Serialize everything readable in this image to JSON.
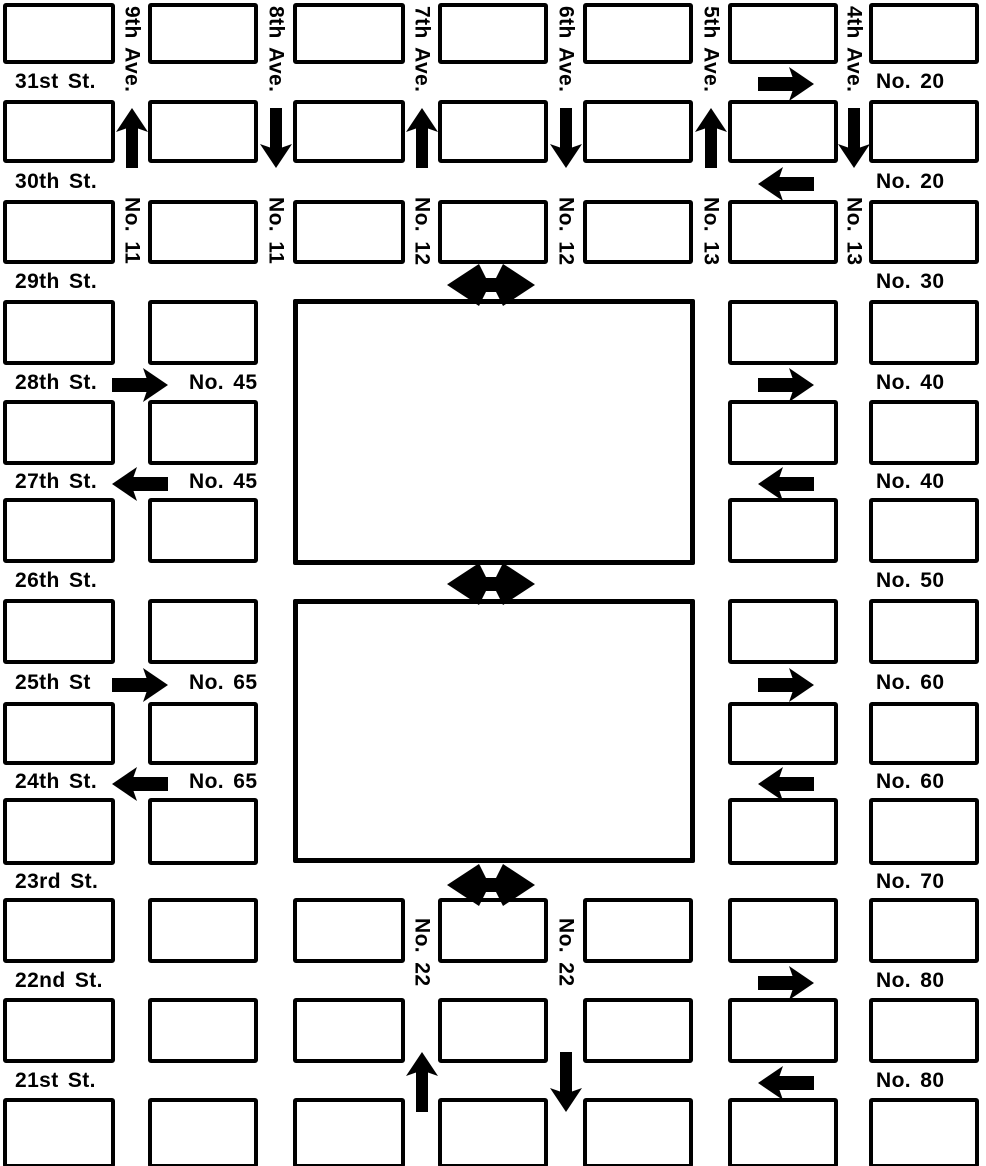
{
  "map": {
    "colors": {
      "ink": "#000000",
      "paper": "#ffffff"
    },
    "street_labels": [
      {
        "label": "31st St.",
        "row": 0
      },
      {
        "label": "30th St.",
        "row": 1
      },
      {
        "label": "29th St.",
        "row": 2
      },
      {
        "label": "28th St.",
        "row": 3
      },
      {
        "label": "27th St.",
        "row": 4
      },
      {
        "label": "26th St.",
        "row": 5
      },
      {
        "label": "25th St",
        "row": 6
      },
      {
        "label": "24th St.",
        "row": 7
      },
      {
        "label": "23rd St.",
        "row": 8
      },
      {
        "label": "22nd St.",
        "row": 9
      },
      {
        "label": "21st St.",
        "row": 10
      }
    ],
    "avenue_labels": [
      {
        "label": "9th Ave.",
        "avenue": 0
      },
      {
        "label": "8th Ave.",
        "avenue": 1
      },
      {
        "label": "7th Ave.",
        "avenue": 2
      },
      {
        "label": "6th Ave.",
        "avenue": 3
      },
      {
        "label": "5th Ave.",
        "avenue": 4
      },
      {
        "label": "4th Ave.",
        "avenue": 5
      }
    ],
    "route_labels_right": [
      {
        "label": "No. 20",
        "street_band": 0
      },
      {
        "label": "No. 20",
        "street_band": 1
      },
      {
        "label": "No. 30",
        "street_band": 2
      },
      {
        "label": "No. 40",
        "street_band": 3
      },
      {
        "label": "No. 40",
        "street_band": 4
      },
      {
        "label": "No. 50",
        "street_band": 5
      },
      {
        "label": "No. 60",
        "street_band": 6
      },
      {
        "label": "No. 60",
        "street_band": 7
      },
      {
        "label": "No. 70",
        "street_band": 8
      },
      {
        "label": "No. 80",
        "street_band": 9
      },
      {
        "label": "No. 80",
        "street_band": 10
      }
    ],
    "route_labels_mid": [
      {
        "label": "No. 45",
        "street_band": 3
      },
      {
        "label": "No. 45",
        "street_band": 4
      },
      {
        "label": "No. 65",
        "street_band": 6
      },
      {
        "label": "No. 65",
        "street_band": 7
      }
    ],
    "route_labels_vertical": [
      {
        "label": "No. 11",
        "avenue": 0,
        "row": 2
      },
      {
        "label": "No. 11",
        "avenue": 1,
        "row": 2
      },
      {
        "label": "No. 12",
        "avenue": 2,
        "row": 2
      },
      {
        "label": "No. 12",
        "avenue": 3,
        "row": 2
      },
      {
        "label": "No. 13",
        "avenue": 4,
        "row": 2
      },
      {
        "label": "No. 13",
        "avenue": 5,
        "row": 2
      },
      {
        "label": "No. 22",
        "avenue": 2,
        "row": 9
      },
      {
        "label": "No. 22",
        "avenue": 3,
        "row": 9
      }
    ],
    "arrows": [
      {
        "dir": "up",
        "avenue": 0,
        "row": 1
      },
      {
        "dir": "down",
        "avenue": 1,
        "row": 1
      },
      {
        "dir": "up",
        "avenue": 2,
        "row": 1
      },
      {
        "dir": "down",
        "avenue": 3,
        "row": 1
      },
      {
        "dir": "up",
        "avenue": 4,
        "row": 1
      },
      {
        "dir": "down",
        "avenue": 5,
        "row": 1
      },
      {
        "dir": "up",
        "avenue": 2,
        "row": 10
      },
      {
        "dir": "down",
        "avenue": 3,
        "row": 10
      },
      {
        "dir": "right",
        "street_band": 0,
        "side": "right"
      },
      {
        "dir": "left",
        "street_band": 1,
        "side": "right"
      },
      {
        "dir": "right",
        "street_band": 3,
        "side": "left"
      },
      {
        "dir": "right",
        "street_band": 3,
        "side": "right"
      },
      {
        "dir": "left",
        "street_band": 4,
        "side": "left"
      },
      {
        "dir": "left",
        "street_band": 4,
        "side": "right"
      },
      {
        "dir": "right",
        "street_band": 6,
        "side": "left"
      },
      {
        "dir": "right",
        "street_band": 6,
        "side": "right"
      },
      {
        "dir": "left",
        "street_band": 7,
        "side": "left"
      },
      {
        "dir": "left",
        "street_band": 7,
        "side": "right"
      },
      {
        "dir": "right",
        "street_band": 9,
        "side": "right"
      },
      {
        "dir": "left",
        "street_band": 10,
        "side": "right"
      },
      {
        "dir": "double",
        "street_band": 2
      },
      {
        "dir": "double",
        "street_band": 5
      },
      {
        "dir": "double",
        "street_band": 8
      }
    ]
  }
}
